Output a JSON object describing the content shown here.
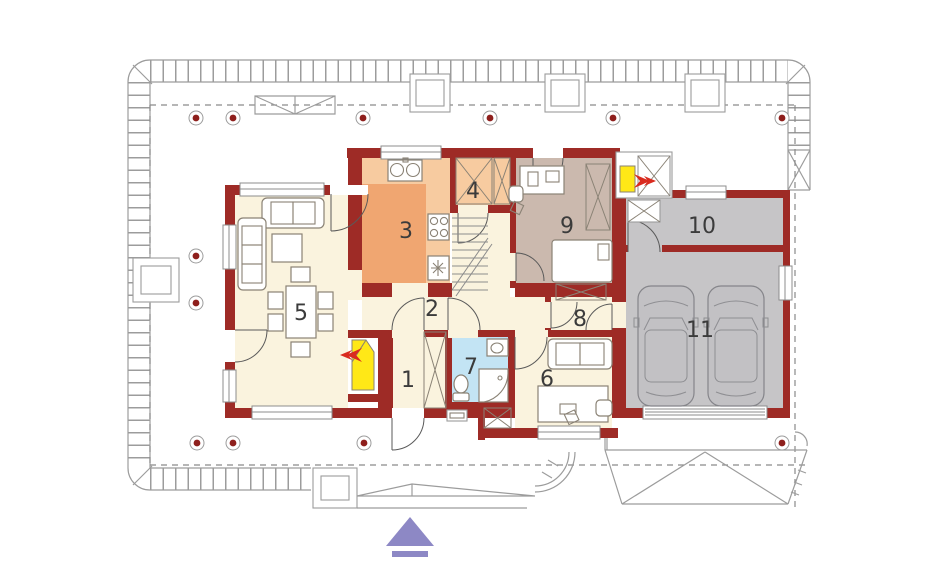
{
  "plan": {
    "kind": "house-ground-floor-plan",
    "entrance_marker": {
      "shape": "triangle-up",
      "color": "#8D88C5"
    }
  },
  "rooms": [
    {
      "label": "1",
      "fill": "#FAF3DE"
    },
    {
      "label": "2",
      "fill": "#FAF3DE"
    },
    {
      "label": "3",
      "fill": "#F0A671"
    },
    {
      "label": "4",
      "fill": "#F7CBA0"
    },
    {
      "label": "5",
      "fill": "#FAF3DE"
    },
    {
      "label": "6",
      "fill": "#FAF3DE"
    },
    {
      "label": "7",
      "fill": "#C3E4F4"
    },
    {
      "label": "8",
      "fill": "#FAF3DE"
    },
    {
      "label": "9",
      "fill": "#CBB9AE"
    },
    {
      "label": "10",
      "fill": "#C6C5C7"
    },
    {
      "label": "11",
      "fill": "#C6C5C7"
    }
  ],
  "palette": {
    "wall": "#9E2B26",
    "counter": "#F7CBA0",
    "fireplace_yellow": "#FFE817",
    "flow_arrow_red": "#D92B1F",
    "entrance_purple": "#8D88C5",
    "post_dot_red": "#8E1F1C",
    "car_gray": "#C2C1C4",
    "garage_gray": "#C6C5C7",
    "cream": "#FAF3DE"
  }
}
